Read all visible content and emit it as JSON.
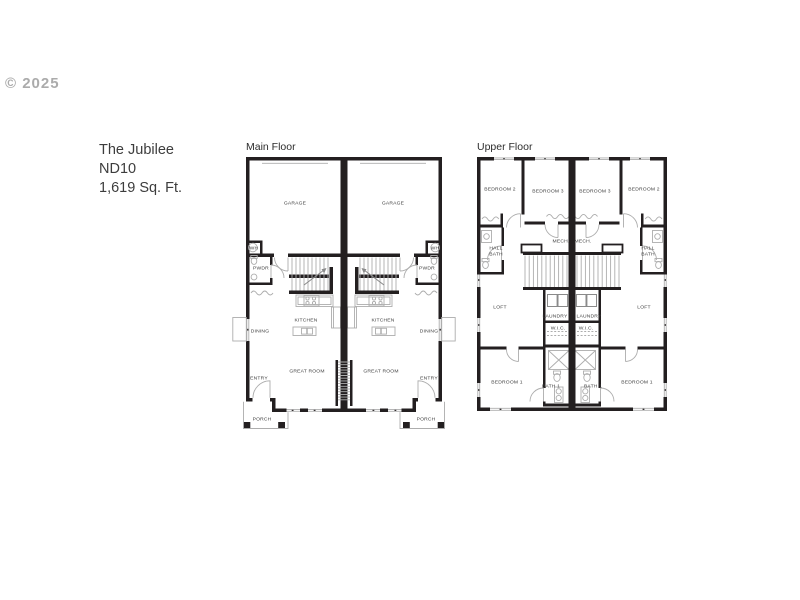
{
  "watermark": "© 2025",
  "property": {
    "name": "The Jubilee",
    "plan_code": "ND10",
    "area": "1,619 Sq. Ft."
  },
  "floors": {
    "main": {
      "title": "Main Floor",
      "rooms": {
        "garage": "GARAGE",
        "wh": "WH",
        "pwdr": "PWDR",
        "kitchen": "KITCHEN",
        "dining": "DINING",
        "great_room": "GREAT ROOM",
        "entry": "ENTRY",
        "porch": "PORCH"
      }
    },
    "upper": {
      "title": "Upper Floor",
      "rooms": {
        "bedroom2": "BEDROOM 2",
        "bedroom3": "BEDROOM 3",
        "mech": "MECH.",
        "hall_bath_line1": "HALL",
        "hall_bath_line2": "BATH",
        "loft": "LOFT",
        "laundry": "LAUNDRY",
        "wic": "W.I.C.",
        "bedroom1": "BEDROOM 1",
        "bath1": "BATH 1"
      }
    }
  },
  "colors": {
    "wall": "#231f20",
    "detail_line": "#adadad",
    "label_text": "#3c3c3c",
    "watermark_text": "#9d9d9d",
    "background": "#ffffff"
  }
}
